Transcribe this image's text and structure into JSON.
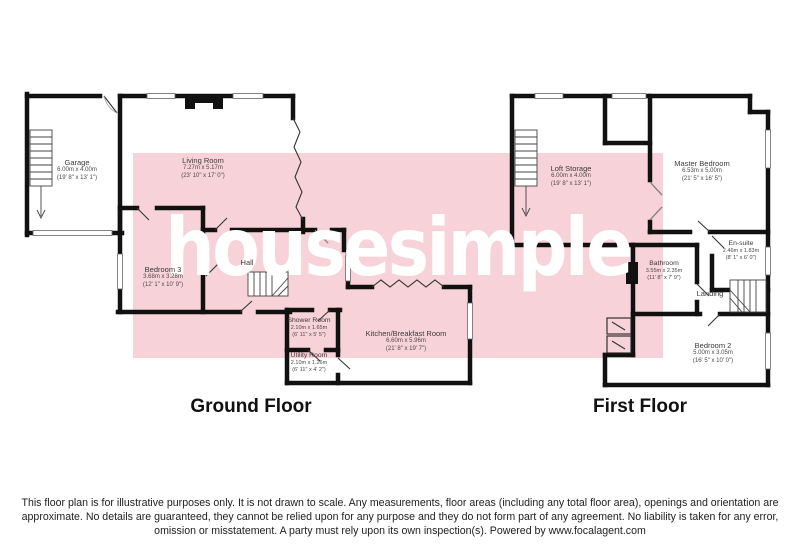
{
  "watermark": "housesimple",
  "colors": {
    "overlay_pink": "#f8d2d9",
    "wall": "#111111",
    "watermark_text": "#ffffff",
    "label_text": "#3a3a3a"
  },
  "floors": [
    {
      "title": "Ground Floor",
      "rooms": [
        {
          "name": "Garage",
          "metric": "6.00m x 4.00m",
          "imperial": "(19' 8\" x 13' 1\")"
        },
        {
          "name": "Living Room",
          "metric": "7.27m x 5.17m",
          "imperial": "(23' 10\" x 17' 0\")"
        },
        {
          "name": "Bedroom 3",
          "metric": "3.68m x 3.28m",
          "imperial": "(12' 1\" x 10' 9\")"
        },
        {
          "name": "Hall"
        },
        {
          "name": "Shower Room",
          "metric": "2.10m x 1.65m",
          "imperial": "(6' 11\" x 5' 5\")"
        },
        {
          "name": "Utility Room",
          "metric": "2.10m x 1.26m",
          "imperial": "(6' 11\" x 4' 2\")"
        },
        {
          "name": "Kitchen/Breakfast Room",
          "metric": "6.60m x 5.96m",
          "imperial": "(21' 8\" x 19' 7\")"
        }
      ]
    },
    {
      "title": "First Floor",
      "rooms": [
        {
          "name": "Loft Storage",
          "metric": "6.00m x 4.00m",
          "imperial": "(19' 8\" x 13' 1\")"
        },
        {
          "name": "Master Bedroom",
          "metric": "6.53m x 5.00m",
          "imperial": "(21' 5\" x 16' 5\")"
        },
        {
          "name": "En-suite",
          "metric": "2.46m x 1.83m",
          "imperial": "(8' 1\" x 6' 0\")"
        },
        {
          "name": "Bathroom",
          "metric": "3.55m x 2.35m",
          "imperial": "(11' 8\" x 7' 9\")"
        },
        {
          "name": "Landing"
        },
        {
          "name": "Bedroom 2",
          "metric": "5.00m x 3.05m",
          "imperial": "(16' 5\" x 10' 0\")"
        }
      ]
    }
  ],
  "disclaimer": {
    "line1": "This floor plan is for illustrative purposes only. It is not drawn to scale. Any measurements, floor areas (including any total floor area), openings and orientation are",
    "line2": "approximate. No details are guaranteed, they cannot be relied upon for any purpose and they do not form part of any agreement. No liability is taken for any error,",
    "line3": "omission or misstatement. A party must rely upon its own inspection(s). Powered by www.focalagent.com"
  }
}
